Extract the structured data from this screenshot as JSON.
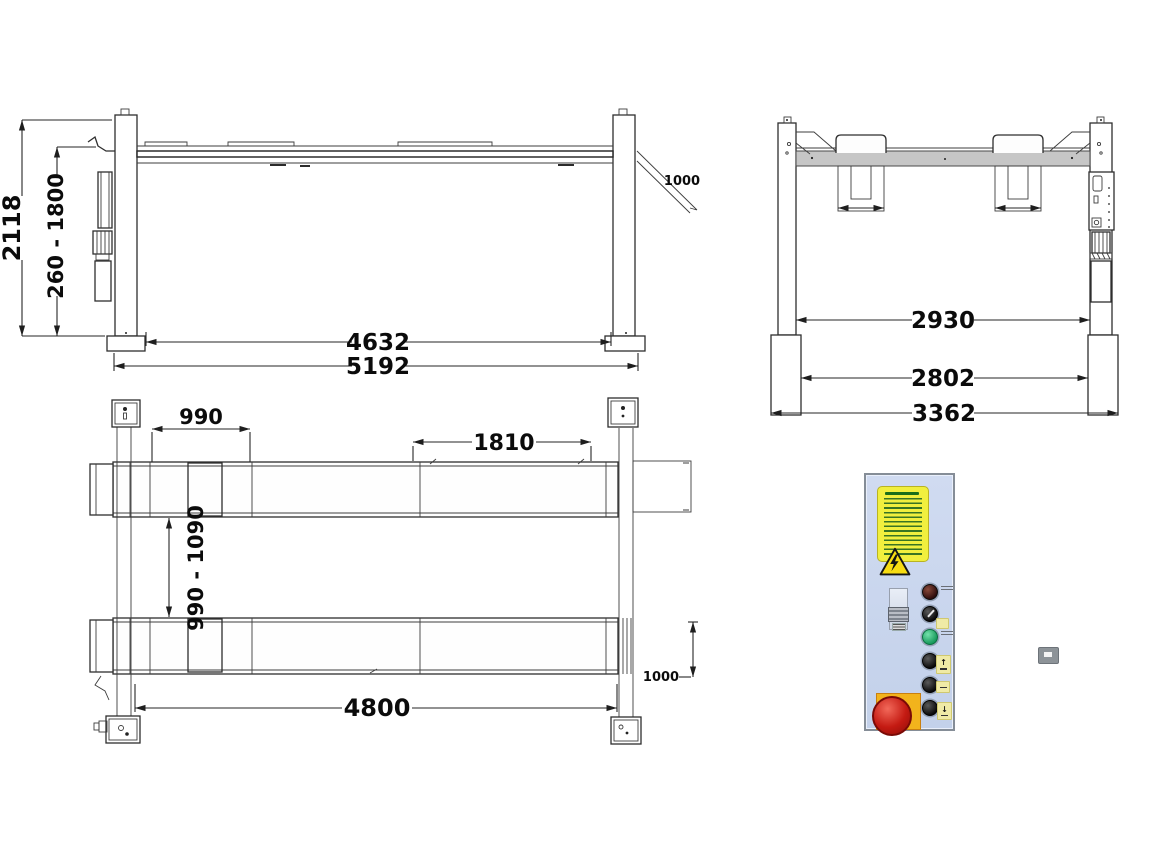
{
  "side_view": {
    "height_overall": "2118",
    "lift_range": "260 - 1800",
    "inner_span": "4632",
    "overall_length": "5192",
    "ramp_length": "1000"
  },
  "front_view": {
    "clear_width": "2930",
    "inner_base_width": "2802",
    "overall_base_width": "3362"
  },
  "plan_view": {
    "front_offset": "990",
    "center_window": "1810",
    "runway_gap_range": "990 - 1090",
    "runway_length": "4800",
    "ramp_length": "1000"
  },
  "control_panel": {
    "up_glyph": "↑",
    "down_glyph": "↓",
    "panel_color": "#cbd7ee",
    "sticker_color": "#f1ef3e",
    "warning_color": "#f7dc12",
    "estop_color": "#c41a12",
    "start_button_color": "#27a866",
    "power_indicator_color": "#5a221c",
    "line_color": "#2e2e2e"
  }
}
